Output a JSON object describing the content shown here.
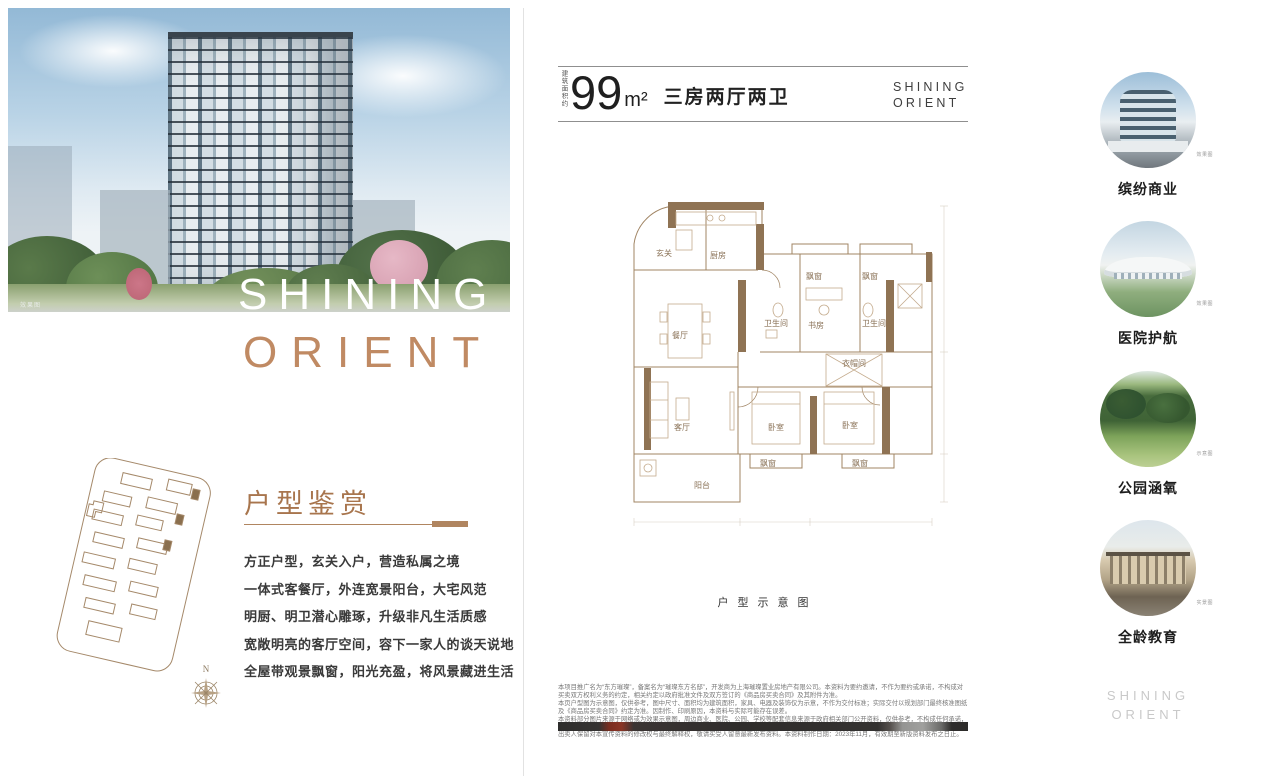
{
  "left": {
    "photo_tag": "效果图",
    "hero_line1": "SHINING",
    "hero_line2": "ORIENT",
    "section_title": "户型鉴赏",
    "paragraph": [
      "方正户型，玄关入户，营造私属之境",
      "一体式客餐厅，外连宽景阳台，大宅风范",
      "明厨、明卫潜心雕琢，升级非凡生活质感",
      "宽敞明亮的客厅空间，容下一家人的谈天说地",
      "全屋带观景飘窗，阳光充盈，将风景藏进生活"
    ],
    "compass": "N"
  },
  "center": {
    "area_prefix": "建筑面积约",
    "area_value": "99",
    "area_unit": "m²",
    "area_desc": "三房两厅两卫",
    "brand_line1": "SHINING",
    "brand_line2": "ORIENT",
    "caption": "户型示意图",
    "rooms": {
      "entry": "玄关",
      "kitchen": "厨房",
      "dining": "餐厅",
      "living": "客厅",
      "balcony": "阳台",
      "bedroom1": "卧室",
      "bedroom2": "卧室",
      "study": "书房",
      "bath1": "卫生间",
      "bath2": "卫生间",
      "cloak": "衣帽间",
      "bay1": "飘窗",
      "bay2": "飘窗",
      "bay3": "飘窗",
      "bay4": "飘窗"
    },
    "disclaimer": [
      "本项目推广名为“东方璀璨”，备案名为“璀璨东方名邸”，开发商为上海璀璨置业房地产有限公司。本资料为要约邀请，不作为要约或承诺，不构成对买卖双方权利义务的约定，相关约定以政府批准文件及双方签订的《商品房买卖合同》及其附件为准。",
      "本页户型图为示意图，仅供参考，图中尺寸、面积均为建筑面积，家具、电器及装饰仅为示意，不作为交付标准；实际交付以规划部门最终核准图纸及《商品房买卖合同》约定为准。因制作、印刷原因，本资料与实际可能存在误差。",
      "本资料部分图片来源于网络或为效果示意图，周边商业、医院、公园、学校等配套信息来源于政府相关部门公开资料，仅供参考，不构成任何承诺，最终以政府有关部门批准文件及实际建设、交付情况为准。",
      "出卖人保留对本宣传资料的修改权与最终解释权，敬请买受人留意最新发布资料。本资料制作日期：2023年11月，有效期至新版资料发布之日止。"
    ]
  },
  "right": {
    "items": [
      {
        "label": "缤纷商业",
        "tag": "效果图"
      },
      {
        "label": "医院护航",
        "tag": "效果图"
      },
      {
        "label": "公园涵氧",
        "tag": "示意图"
      },
      {
        "label": "全龄教育",
        "tag": "实景图"
      }
    ],
    "brand_line1": "SHINING",
    "brand_line2": "ORIENT"
  },
  "colors": {
    "accent_bronze": "#b08560",
    "hero_orient": "#c08a63",
    "text_dark": "#1f1f1f",
    "footer_gray": "#c9c9c9"
  }
}
